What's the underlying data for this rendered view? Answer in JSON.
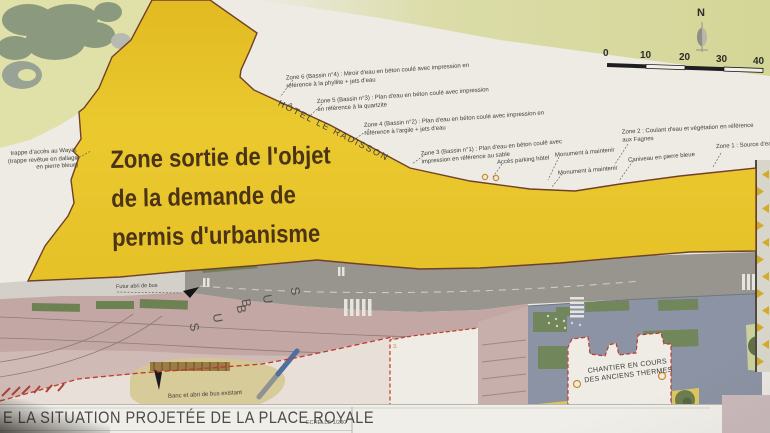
{
  "overlay": {
    "line1": "Zone sortie de l'objet",
    "line2": "de la demande de",
    "line3": "permis d'urbanisme"
  },
  "compass": {
    "north": "N"
  },
  "scale_bar": {
    "ticks": [
      "0",
      "10",
      "20",
      "30",
      "40"
    ]
  },
  "callouts": {
    "zone6": "Zone 6 (Bassin n°4) : Miroir d'eau en béton coulé avec impression en référence à la phyllite + jets d'eau",
    "zone5": "Zone 5 (Bassin n°3) : Plan d'eau en béton coulé avec impression en référence à la quartzite",
    "zone4": "Zone 4 (Bassin n°2) : Plan d'eau en béton coulé avec impression en référence à l'argile + jets d'eau",
    "zone3": "Zone 3 (Bassin n°1) : Plan d'eau en béton coulé avec impression en référence au sable",
    "zone2": "Zone 2 : Coulant d'eau et végétation en référence aux Fagnes",
    "zone1": "Zone 1 : Source d'eau en référence aux tou",
    "acces_parking": "Accès parking hôtel",
    "monument_1": "Monument à maintenir",
    "monument_2": "Monument à maintenir",
    "caniveau": "Caniveau en pierre bleue",
    "trappe_line1": "trappe d'accès au Wayai.",
    "trappe_line2": "(trappe revêtue en dallage",
    "trappe_line3": "en pierre bleue)"
  },
  "labels": {
    "hotel": "HÔTEL LE RADISSON",
    "futur_abri": "Futur abri de bus",
    "banc_abri": "Banc et abri de bus existant",
    "chantier_line1": "CHANTIER EN COURS",
    "chantier_line2": "DES ANCIENS THERMES",
    "building_number": "3."
  },
  "road": {
    "bus_letters": [
      "S",
      "U",
      "B",
      "B",
      "U",
      "S"
    ]
  },
  "title_block": {
    "title": "E LA SITUATION PROJETÉE DE LA PLACE ROYALE",
    "scale_note": "ECHELLE 1/200"
  },
  "colors": {
    "zone_yellow": "#e8c42a",
    "zone_border": "#6f4128",
    "red_boundary": "#c0392b",
    "road_pink": "#c3a7a4",
    "road_grey": "#98958f",
    "plaza_blue_grey": "#8b93a4",
    "vegetation_green": "#72865b",
    "pale_green": "#dfe0a6",
    "olive_band": "#d8da9e",
    "tan_ground": "#d5c88f",
    "orange_marker": "#cf8b2f",
    "paper": "#edebe4"
  }
}
